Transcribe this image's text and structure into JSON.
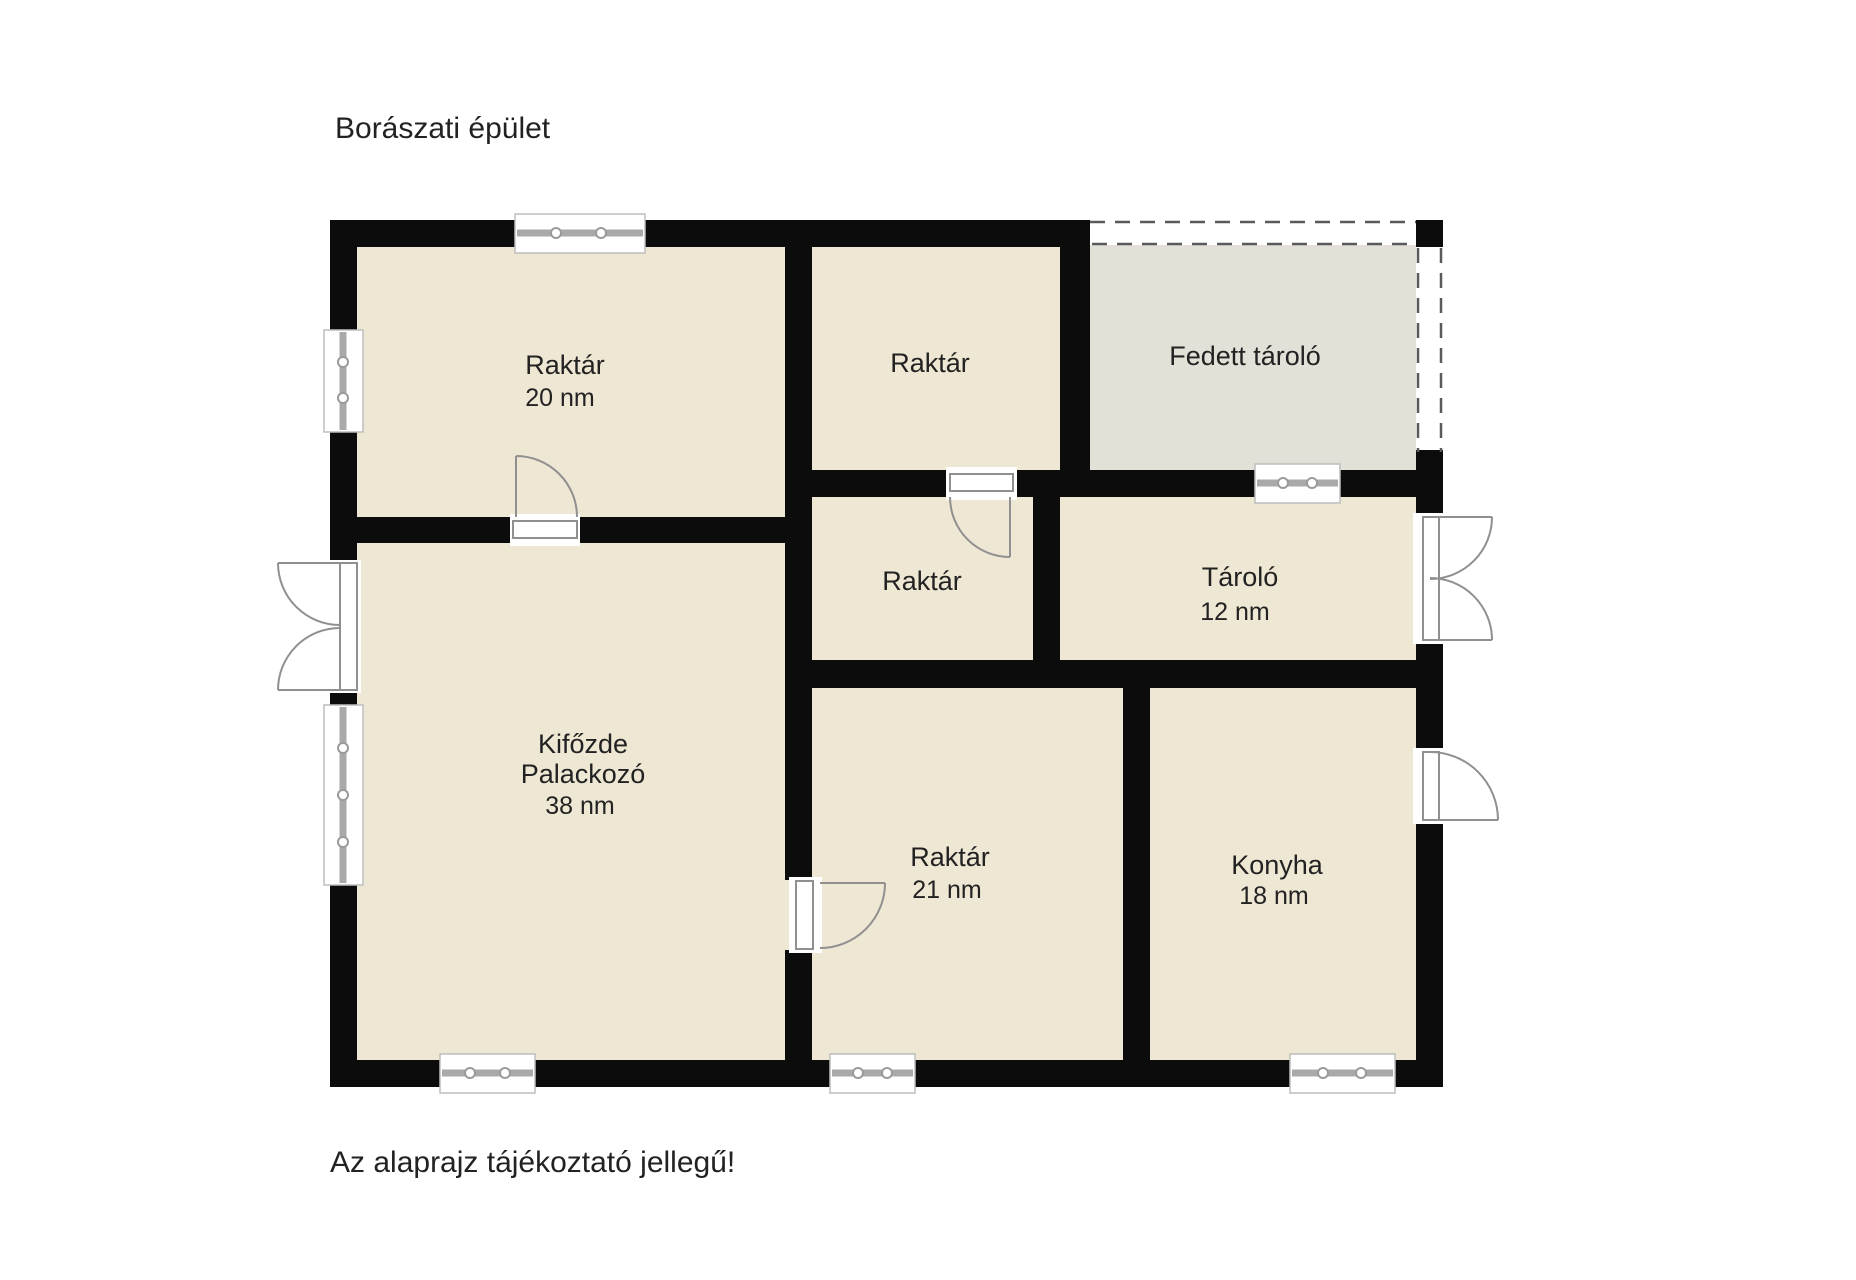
{
  "page": {
    "title": "Borászati épület",
    "footnote": "Az alaprajz tájékoztató jellegű!"
  },
  "colors": {
    "room_fill": "#EEE7D3",
    "covered_area_fill": "#E3E0D8",
    "wall": "#0C0C0C",
    "door_window_symbol_stroke": "#909090",
    "dashed_boundary": "#5A5A5A",
    "text": "#222222",
    "background": "#FFFFFF"
  },
  "rooms": [
    {
      "id": "raktar-20",
      "label": "Raktár",
      "area": "20 nm"
    },
    {
      "id": "raktar-top",
      "label": "Raktár",
      "area": ""
    },
    {
      "id": "fedett-tarolo",
      "label": "Fedett tároló",
      "area": ""
    },
    {
      "id": "raktar-mid",
      "label": "Raktár",
      "area": ""
    },
    {
      "id": "tarolo",
      "label": "Tároló",
      "area": "12 nm"
    },
    {
      "id": "kifozde",
      "label": "Kifőzde",
      "label2": "Palackozó",
      "area": "38 nm"
    },
    {
      "id": "raktar-21",
      "label": "Raktár",
      "area": "21 nm"
    },
    {
      "id": "konyha",
      "label": "Konyha",
      "area": "18 nm"
    }
  ]
}
